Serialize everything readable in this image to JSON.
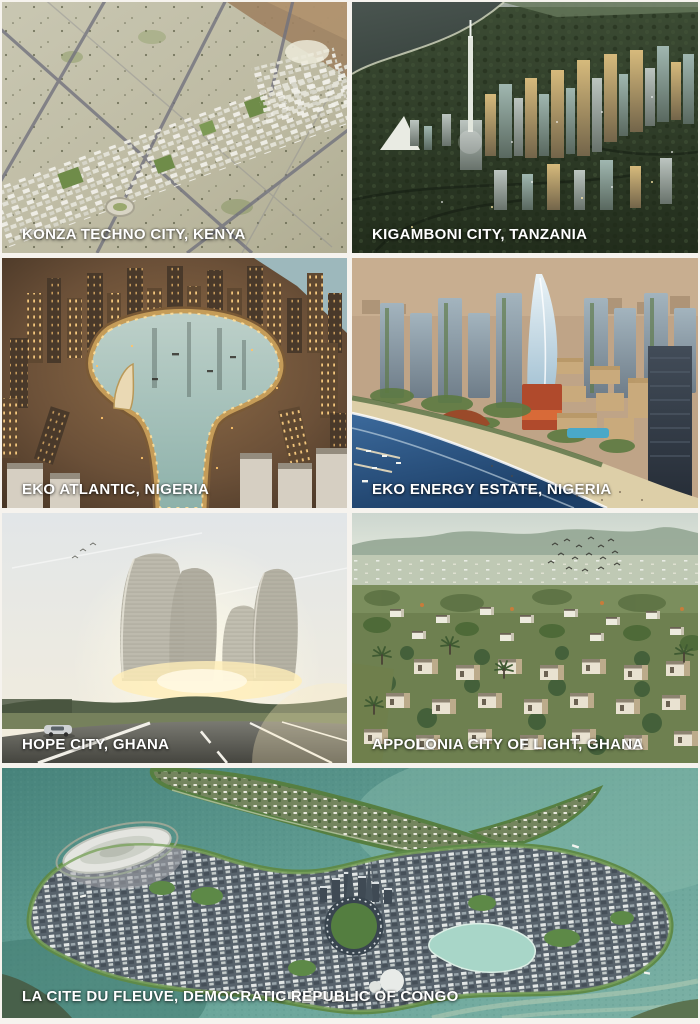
{
  "page": {
    "background_color": "#f6f3ee",
    "caption_color": "#ffffff"
  },
  "panels": [
    {
      "id": "konza",
      "caption": "KONZA TECHNO CITY, KENYA"
    },
    {
      "id": "kigamboni",
      "caption": "KIGAMBONI CITY, TANZANIA"
    },
    {
      "id": "eko-atlantic",
      "caption": "EKO ATLANTIC, NIGERIA"
    },
    {
      "id": "eko-energy",
      "caption": "EKO ENERGY ESTATE, NIGERIA"
    },
    {
      "id": "hope-city",
      "caption": "HOPE CITY, GHANA"
    },
    {
      "id": "appolonia",
      "caption": "APPOLONIA CITY OF LIGHT, GHANA"
    },
    {
      "id": "la-cite-du-fleuve",
      "caption": "LA CITE DU FLEUVE, DEMOCRATIC REPUBLIC OF CONGO"
    }
  ]
}
